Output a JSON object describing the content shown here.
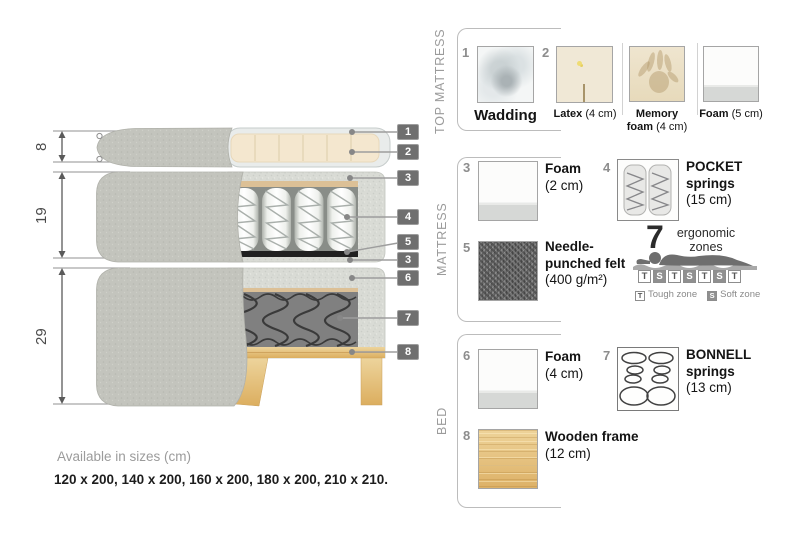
{
  "diagram": {
    "measure_top": "8",
    "measure_mid": "19",
    "measure_bottom": "29",
    "callouts": [
      "1",
      "2",
      "3",
      "4",
      "5",
      "3",
      "6",
      "7",
      "8"
    ]
  },
  "top_mattress": {
    "title": "TOP MATTRESS",
    "item1_num": "1",
    "item1_name": "Wadding",
    "item2_num": "2",
    "item2_name": "Latex",
    "item2_size": "(4 cm)",
    "item3_name": "Memory foam",
    "item3_size": "(4 cm)",
    "item4_name": "Foam",
    "item4_size": "(5 cm)"
  },
  "mattress": {
    "title": "MATTRESS",
    "foam_num": "3",
    "foam_name": "Foam",
    "foam_size": "(2 cm)",
    "pocket_num": "4",
    "pocket_name": "POCKET springs",
    "pocket_size": "(15 cm)",
    "felt_num": "5",
    "felt_name": "Needle-punched felt",
    "felt_size": "(400 g/m²)",
    "ergo_number": "7",
    "ergo_label": "ergonomic zones",
    "zones": [
      "T",
      "S",
      "T",
      "S",
      "T",
      "S",
      "T"
    ],
    "zone_tough_key": "T",
    "zone_tough_label": "Tough zone",
    "zone_soft_key": "S",
    "zone_soft_label": "Soft zone"
  },
  "bed": {
    "title": "BED",
    "foam_num": "6",
    "foam_name": "Foam",
    "foam_size": "(4 cm)",
    "bonnell_num": "7",
    "bonnell_name": "BONNELL springs",
    "bonnell_size": "(13 cm)",
    "wood_num": "8",
    "wood_name": "Wooden frame",
    "wood_size": "(12 cm)"
  },
  "footer": {
    "availability": "Available in sizes (cm)",
    "sizes": "120 x 200, 140 x 200, 160 x 200, 180 x 200, 210 x 210."
  },
  "colors": {
    "callout_bg": "#6f6f6f",
    "cover_grey": "#c3c4bd",
    "fabric_light": "#d9dbd5",
    "latex_cream": "#f4e7cf",
    "wood": "#e0b46d",
    "felt_black": "#202020"
  }
}
